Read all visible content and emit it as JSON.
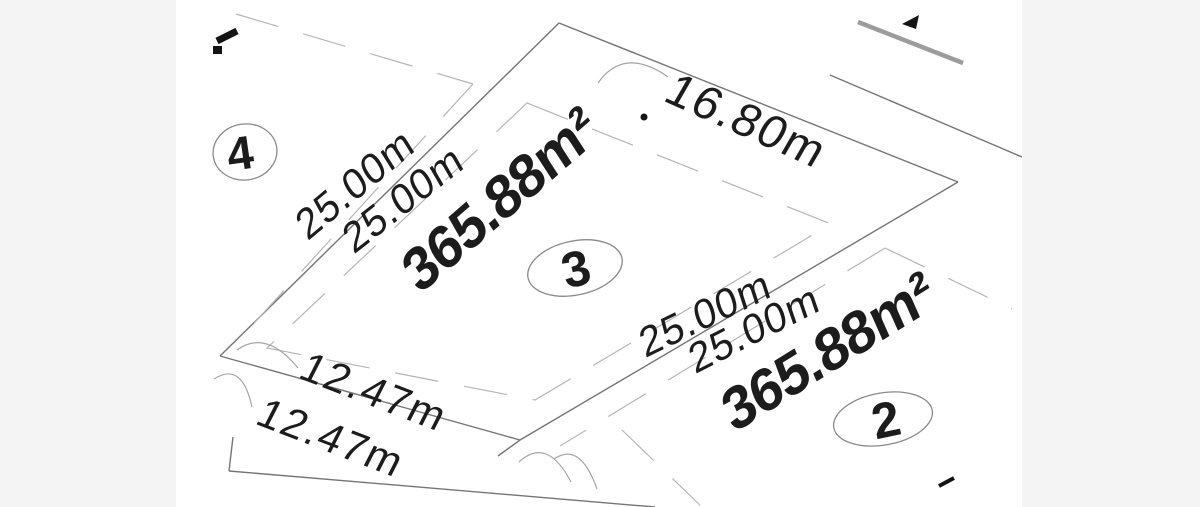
{
  "canvas": {
    "width": 1200,
    "height": 507,
    "background": "#ffffff",
    "letterbox_color": "#f4f4f5",
    "boundary_line_color": "#757575",
    "setback_line_color": "#b5b5b5",
    "road_line_color": "#9c9c9c",
    "arc_color": "#a5a5a5",
    "text_color": "#1c1c1c"
  },
  "plan": {
    "type": "cadastral-subdivision-lot-plan",
    "lots": [
      {
        "number": "3",
        "area": "365.88m²"
      },
      {
        "number": "2",
        "area": "365.88m²"
      },
      {
        "number": "4"
      }
    ],
    "dimensions": [
      {
        "edge": "lot3-rear-boundary",
        "label": "16.80m"
      },
      {
        "edge": "lot4-side-of-shared-boundary",
        "label": "25.00m"
      },
      {
        "edge": "lot3-left-side-boundary",
        "label": "25.00m"
      },
      {
        "edge": "lot3-right-side-boundary",
        "label": "25.00m"
      },
      {
        "edge": "lot2-side-of-shared-boundary",
        "label": "25.00m"
      },
      {
        "edge": "lot4-frontage",
        "label": "12.47m"
      },
      {
        "edge": "lot3-frontage",
        "label": "12.47m"
      }
    ]
  }
}
